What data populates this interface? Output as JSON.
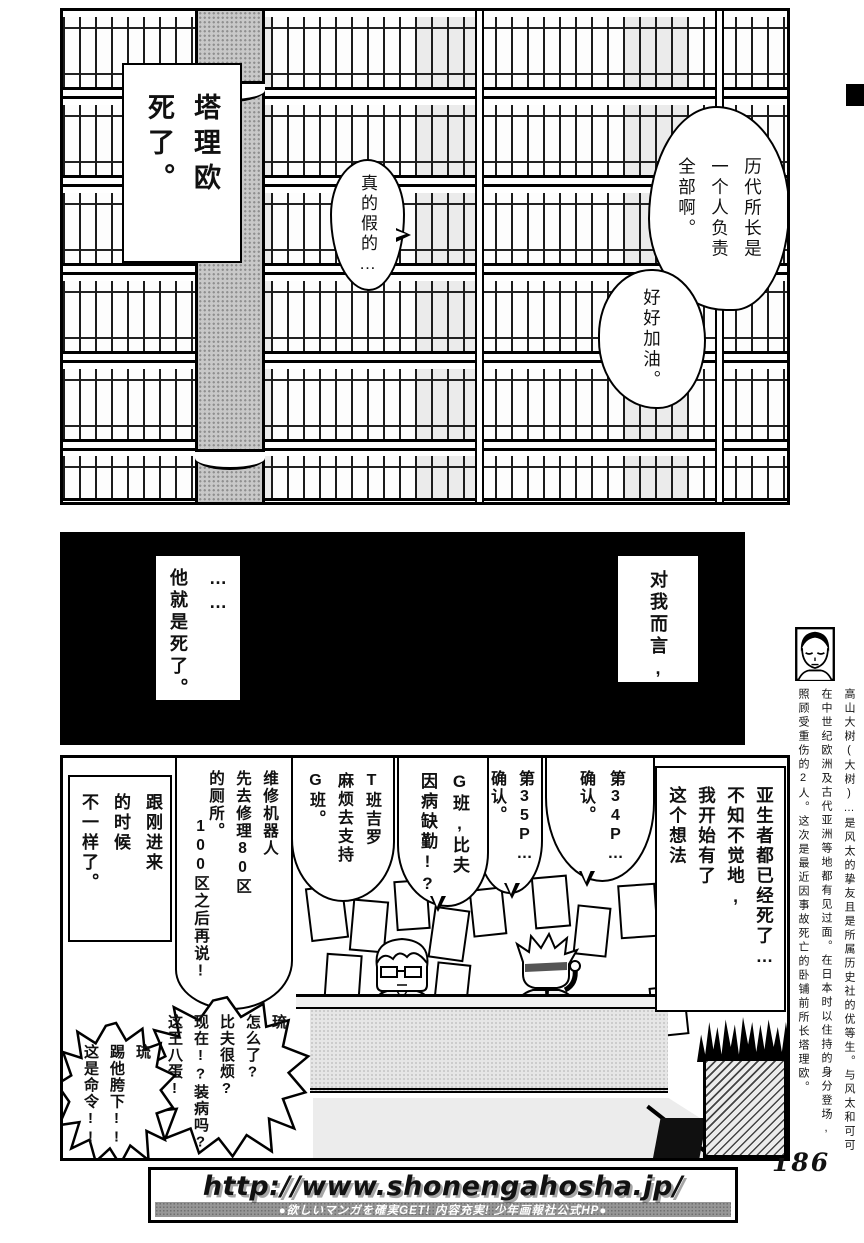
{
  "page": {
    "number": "186"
  },
  "panel1": {
    "caption_box": "塔理欧\n死了。",
    "bubble_really": "真的假的…",
    "bubble_director": "历代所长是\n一个人负责\n全部啊。",
    "bubble_goodluck": "好好加油。"
  },
  "panel2": {
    "box_left": "……\n他就是死了。",
    "box_right": "对我而言,"
  },
  "margin_note": {
    "text": "高山大树(大树)…是风太的挚友且是所属历史社的优等生。与风太和可可\n在中世纪欧洲及古代亚洲等地都有见过面。在日本时以住持的身分登场,\n照顾受重伤的2人。这次是最近因事故死亡的卧铺前所长塔理欧。"
  },
  "panel3": {
    "box_narration": "亚生者都已经死了…\n不知不觉地,\n我开始有了\n这个想法",
    "bubble_p34": "第34P…\n确认。",
    "bubble_p35": "第35P…\n确认。",
    "bubble_g_class": "G班,比夫\n因病缺勤!?",
    "bubble_t_class": "T班吉罗\n麻烦去支持\nG班。",
    "bubble_robot_main": "维修机器人\n先去修理80区\n的厕所。",
    "bubble_robot_sub": "100区之后再说!",
    "box_different": "跟刚进来\n的时候\n不一样了。",
    "bubble_shout_ryu": "琉\n怎么了?\n比夫很烦?\n现在!?装病吗?\n这王八蛋!",
    "bubble_shout_kick": "琉\n踢他胯下!!\n这是命令!!"
  },
  "footer": {
    "url": "http://www.shonengahosha.jp/",
    "tagline": "●欲しいマンガを確実GET! 内容充実! 少年画報社公式HP●"
  },
  "colors": {
    "ink": "#000000",
    "paper": "#ffffff",
    "tone_gray": "#c8c8c8"
  }
}
